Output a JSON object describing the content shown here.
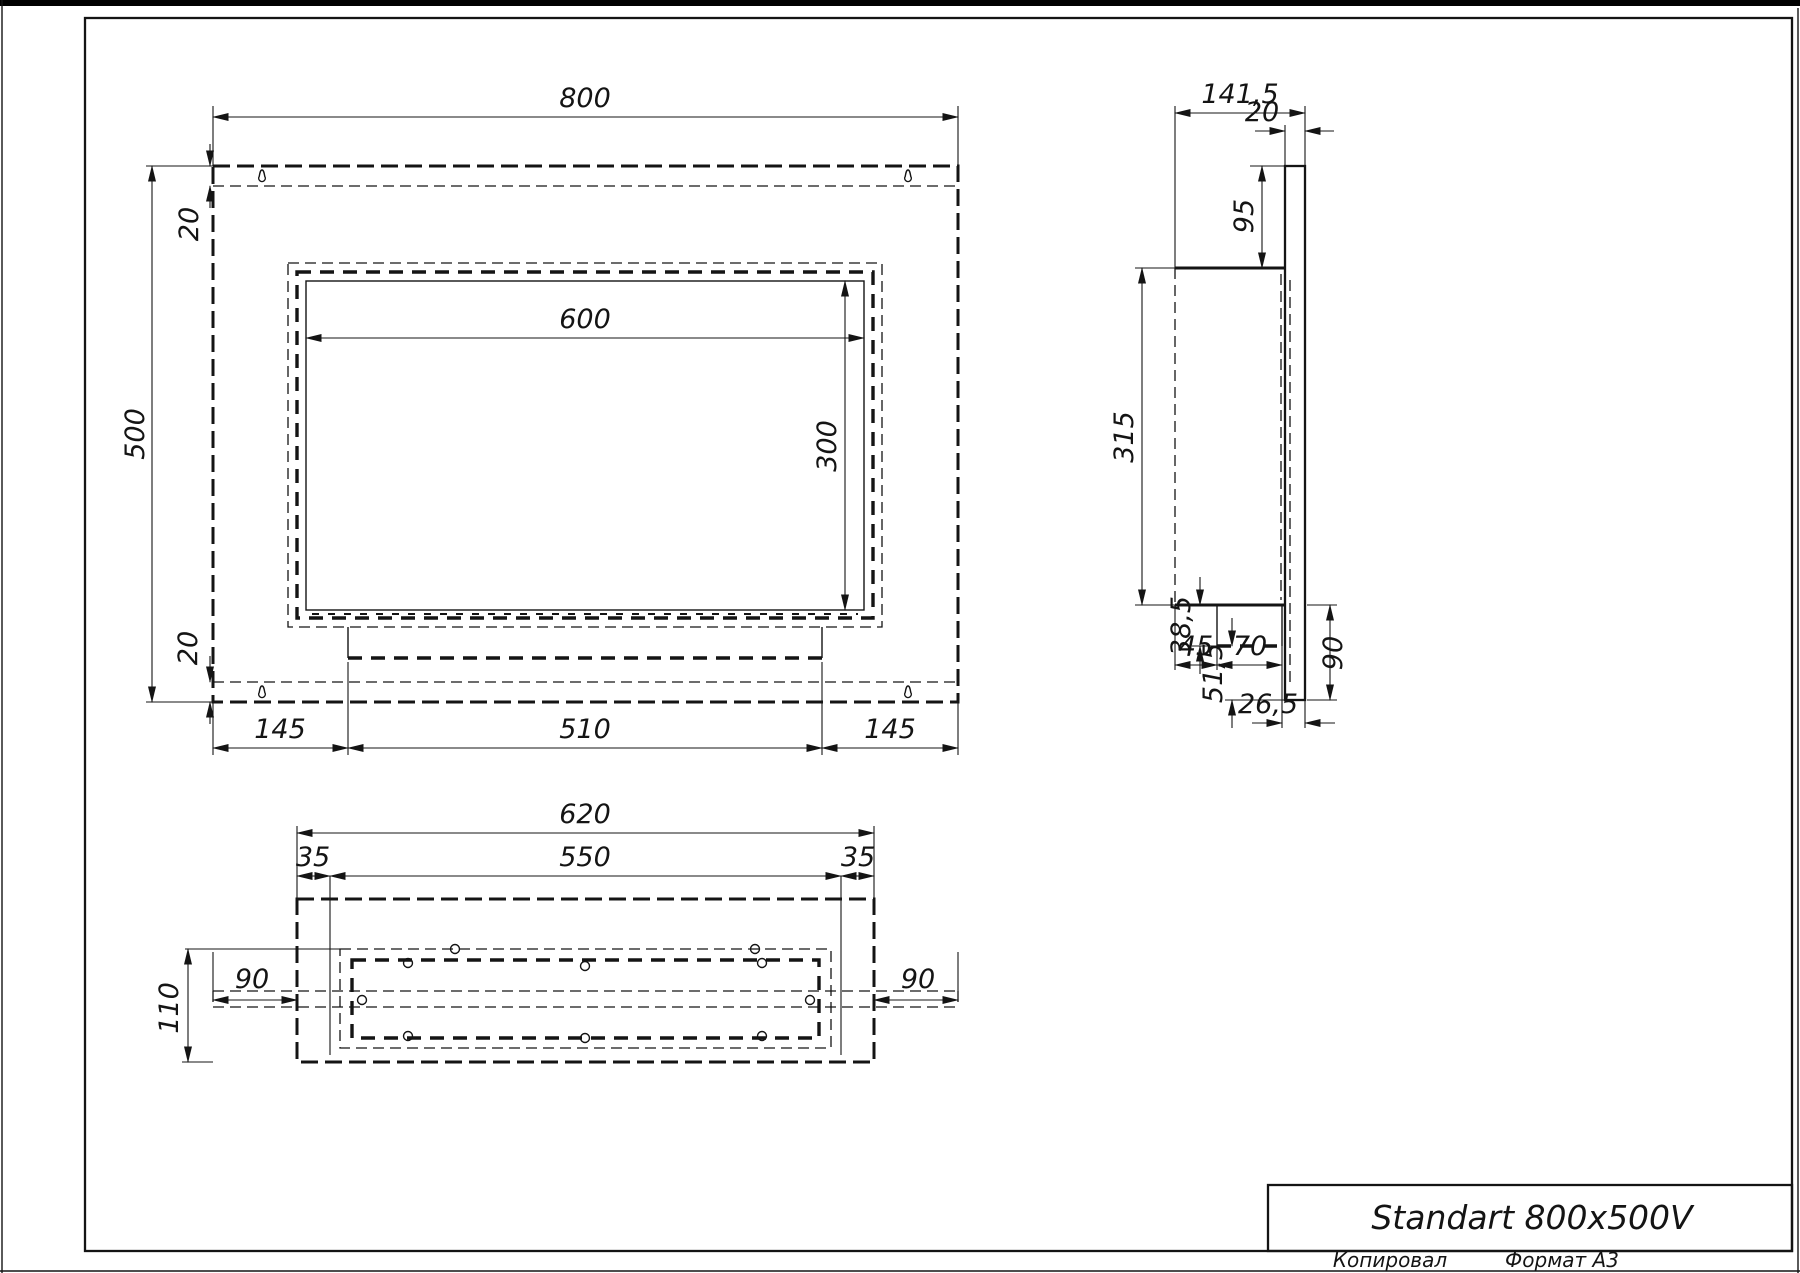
{
  "drawing": {
    "title_block": {
      "model": "Standart 800x500V"
    },
    "footer": {
      "copied": "Копировал",
      "format": "Формат А3"
    },
    "front_view": {
      "width": "800",
      "height": "500",
      "flange_top": "20",
      "flange_bottom": "20",
      "opening_width": "600",
      "opening_height": "300",
      "foot_left": "145",
      "foot_center": "510",
      "foot_right": "145"
    },
    "side_view": {
      "depth": "141,5",
      "plate_thickness": "20",
      "top_offset": "95",
      "body_height": "315",
      "tray_drop": "38,5",
      "bottom_offset": "51,5",
      "front_gap": "45",
      "tray_depth": "70",
      "back_gap": "26,5",
      "plate_drop": "90"
    },
    "bottom_view": {
      "width": "620",
      "opening_width": "550",
      "margin_left": "35",
      "margin_right": "35",
      "depth": "110",
      "flange_left": "90",
      "flange_right": "90"
    },
    "icons": {
      "keyhole": "keyhole-mounting-slot"
    }
  }
}
